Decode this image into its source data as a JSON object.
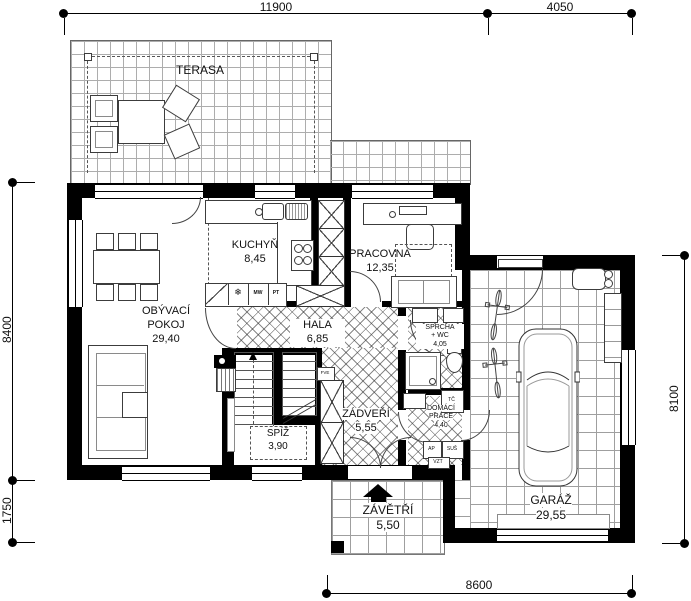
{
  "drawing": {
    "type": "house-floor-plan"
  },
  "dimensions": {
    "top_main": "11900",
    "top_garage": "4050",
    "left_main": "8400",
    "left_porch": "1750",
    "right_garage": "8100",
    "bottom_garage": "8600"
  },
  "rooms": {
    "terasa": {
      "label": "TERASA"
    },
    "kuchyn": {
      "label": "KUCHYŇ",
      "area": "8,45"
    },
    "pracovna": {
      "label": "PRACOVNA",
      "area": "12,35"
    },
    "obyvaci_pokoj": {
      "line1": "OBÝVACÍ",
      "line2": "POKOJ",
      "area": "29,40"
    },
    "hala": {
      "label": "HALA",
      "area": "6,85"
    },
    "sprcha_wc": {
      "line1": "SPRCHA",
      "line2": "+ WC",
      "area": "4,05"
    },
    "spiz": {
      "label": "SPÍŽ",
      "area": "3,90"
    },
    "zadveri": {
      "label": "ZÁDVEŘÍ",
      "area": "5,55"
    },
    "domaci_prace": {
      "line1": "DOMÁCÍ",
      "line2": "PRÁCE",
      "area": "4,40"
    },
    "zavetri": {
      "label": "ZÁVĚTŘÍ",
      "area": "5,50"
    },
    "garaz": {
      "label": "GARÁŽ",
      "area": "29,55"
    }
  },
  "equipment": {
    "fridge_icon": "❄",
    "mw": "MW",
    "pt": "PT",
    "tc": "TČ",
    "ap": "AP",
    "sus": "SUŠ",
    "vzt": "VZT",
    "fve": "FVE"
  },
  "colors": {
    "wall": "#000000",
    "line": "#3c3c3c",
    "tile_grid": "#9f9f9f",
    "hatch": "#555555"
  }
}
